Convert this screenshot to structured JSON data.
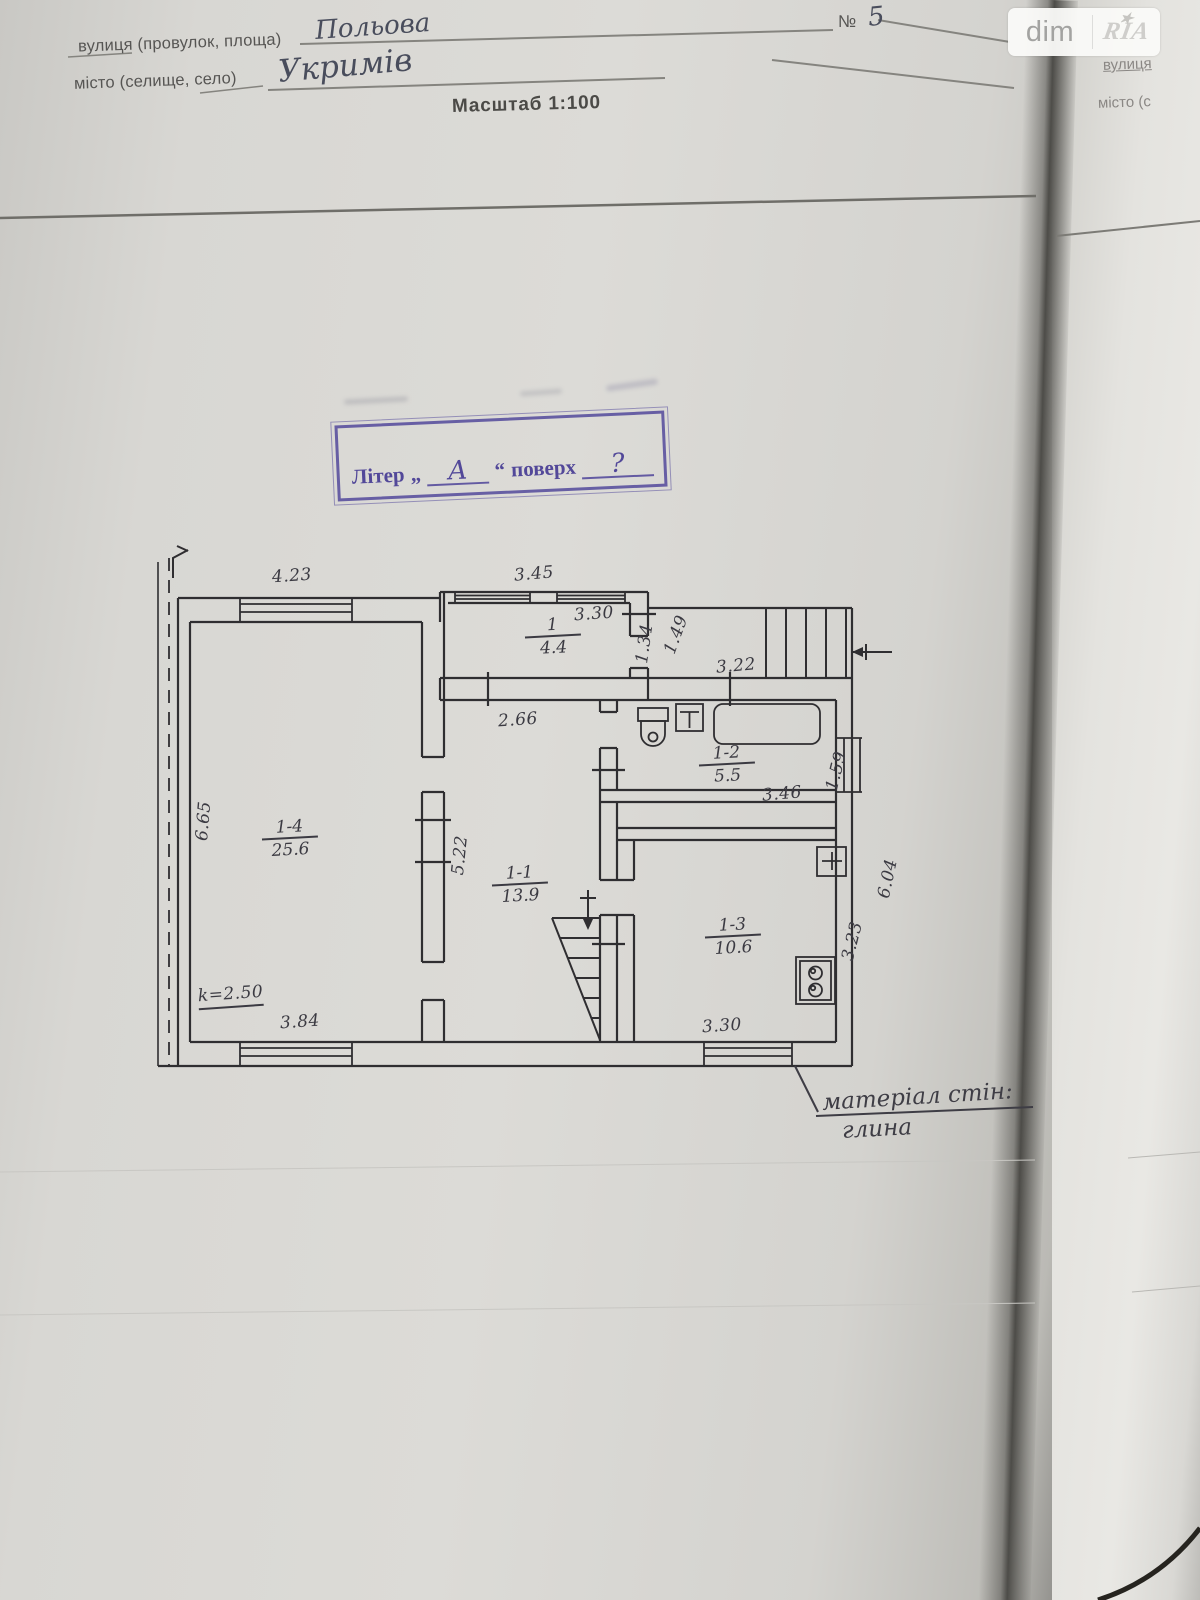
{
  "document": {
    "header": {
      "street_label": "вулиця (провулок, площа)",
      "street_value": "Польова",
      "city_label": "місто (селище, село)",
      "city_value": "Укримів",
      "scale": "Масштаб 1:100",
      "number_sign": "№",
      "number_value": "5"
    },
    "watermark": {
      "dim": "dim",
      "ria": "RIA",
      "star": "★"
    },
    "stamp": {
      "word_liter": "Літер",
      "quote_open": "„",
      "letter": "А",
      "quote_close": "“",
      "word_poverh": "поверх",
      "floor": "?"
    },
    "wall_note_line1": "матеріал стін:",
    "wall_note_line2": "глина",
    "next_page": {
      "street_label": "вулиця",
      "city_label": "місто (с"
    }
  },
  "plan": {
    "rooms": [
      {
        "number": "1",
        "area": "4.4"
      },
      {
        "number": "1-1",
        "area": "13.9"
      },
      {
        "number": "1-2",
        "area": "5.5"
      },
      {
        "number": "1-3",
        "area": "10.6"
      },
      {
        "number": "1-4",
        "area": "25.6"
      }
    ],
    "dims": {
      "top_left_window": "4.23",
      "vestibule_window": "3.45",
      "vestibule_width": "3.30",
      "vestibule_depth": "1.34",
      "porch_door": "1.49",
      "porch_width": "3.22",
      "hall_width": "2.66",
      "hall_depth": "5.22",
      "living_depth": "6.65",
      "living_window": "3.84",
      "ceiling_height": "k=2.50",
      "bath_width": "3.46",
      "bath_depth": "1.59",
      "kitchen_window": "3.30",
      "kitchen_depth": "3.23",
      "east_side": "6.04"
    }
  }
}
